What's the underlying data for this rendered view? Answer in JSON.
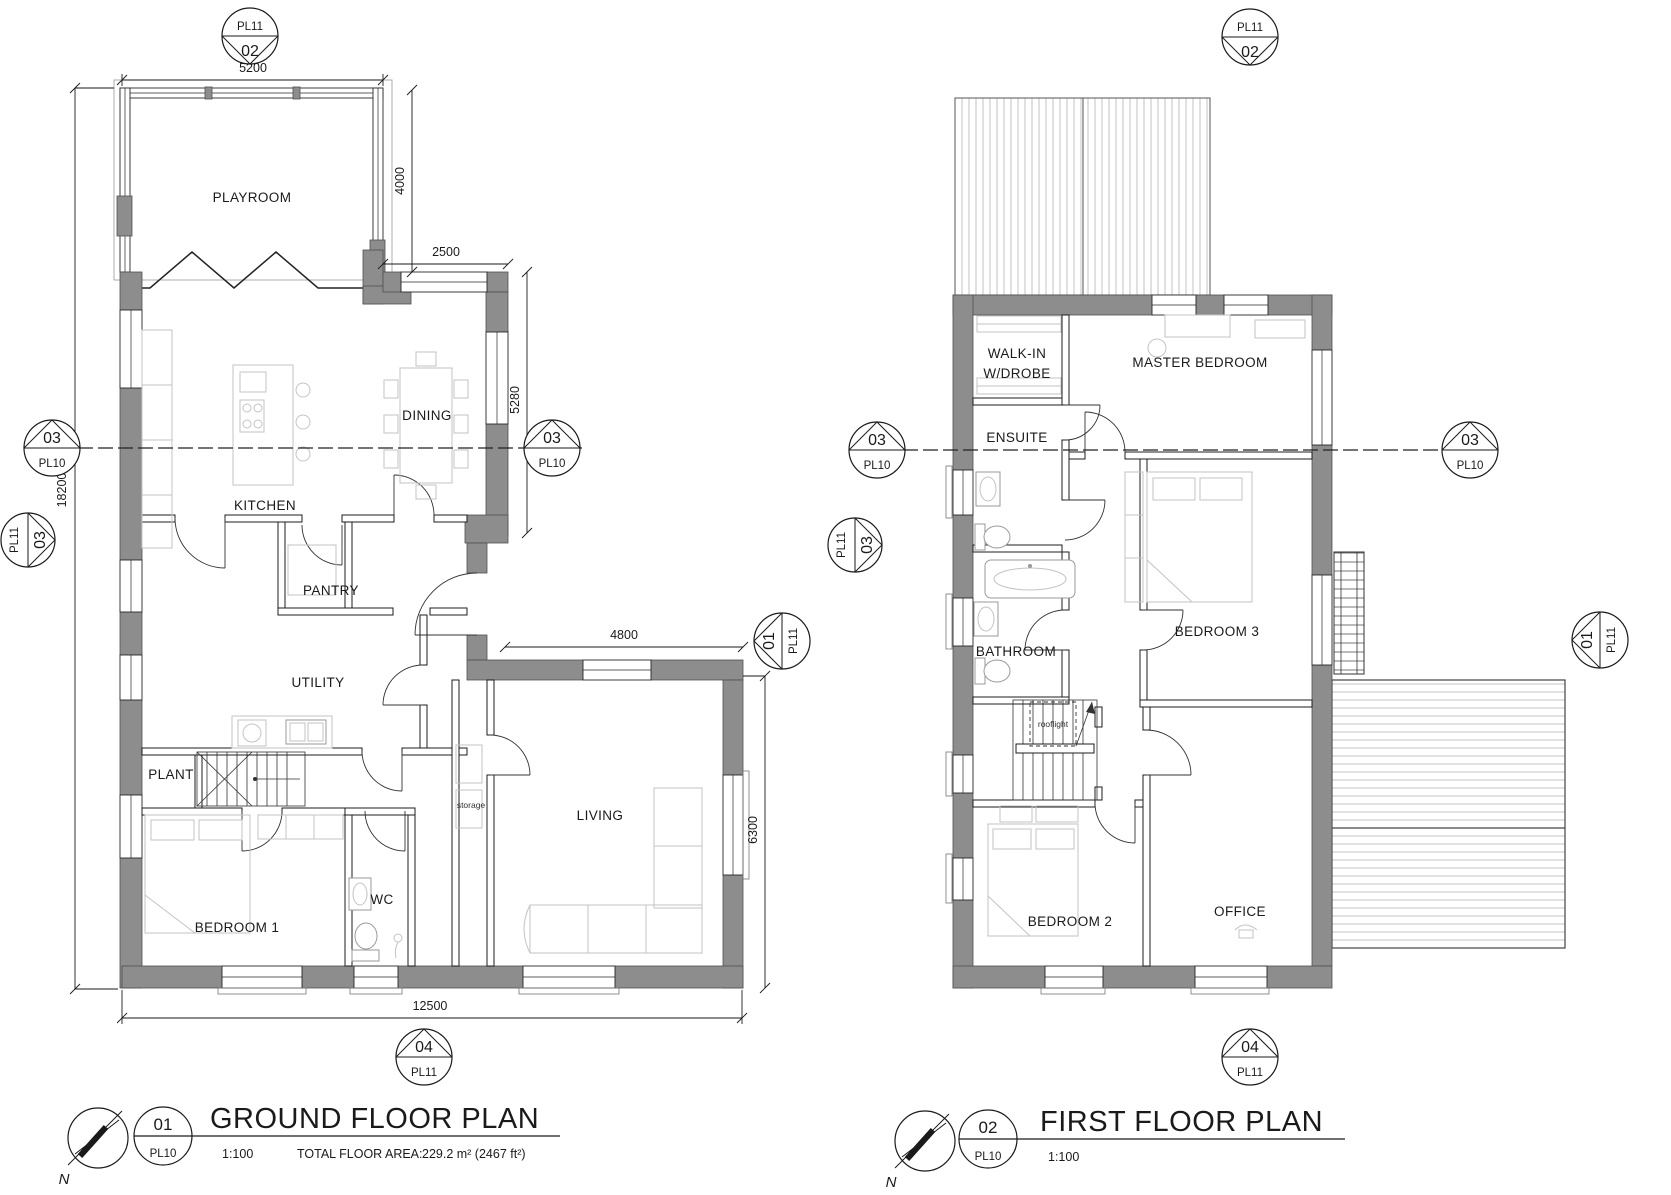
{
  "gf": {
    "title": {
      "number": "01",
      "sheet": "PL10",
      "name": "GROUND FLOOR PLAN",
      "scale": "1:100",
      "area_label": "TOTAL FLOOR AREA:",
      "area_value": "229.2 m² (2467 ft²)"
    },
    "north": "N",
    "rooms": {
      "playroom": "PLAYROOM",
      "dining": "DINING",
      "kitchen": "KITCHEN",
      "pantry": "PANTRY",
      "utility": "UTILITY",
      "plant": "PLANT",
      "bedroom1": "BEDROOM 1",
      "wc": "WC",
      "living": "LIVING",
      "storage": "storage"
    },
    "dims": {
      "top": "5200",
      "playroom_depth": "4000",
      "bay_width": "2500",
      "bay_depth": "5280",
      "overall_height": "18200",
      "living_width": "4800",
      "living_depth": "6300",
      "overall_width": "12500"
    },
    "markers": {
      "top": {
        "sheet": "PL11",
        "num": "02"
      },
      "section_left": {
        "num": "03",
        "sheet": "PL10"
      },
      "section_right": {
        "num": "03",
        "sheet": "PL10"
      },
      "side_left": {
        "sheet": "PL11",
        "num": "03"
      },
      "elev_right": {
        "num": "01",
        "sheet": "PL11"
      },
      "bottom": {
        "num": "04",
        "sheet": "PL11"
      }
    }
  },
  "ff": {
    "title": {
      "number": "02",
      "sheet": "PL10",
      "name": "FIRST FLOOR PLAN",
      "scale": "1:100"
    },
    "north": "N",
    "rooms": {
      "walkin_line1": "WALK-IN",
      "walkin_line2": "W/DROBE",
      "master": "MASTER BEDROOM",
      "ensuite": "ENSUITE",
      "bathroom": "BATHROOM",
      "bedroom3": "BEDROOM 3",
      "bedroom2": "BEDROOM 2",
      "office": "OFFICE",
      "rooflight": "rooflight"
    },
    "markers": {
      "top": {
        "sheet": "PL11",
        "num": "02"
      },
      "section_left": {
        "num": "03",
        "sheet": "PL10"
      },
      "section_right": {
        "num": "03",
        "sheet": "PL10"
      },
      "side_left": {
        "sheet": "PL11",
        "num": "03"
      },
      "elev_right": {
        "num": "01",
        "sheet": "PL11"
      },
      "bottom": {
        "num": "04",
        "sheet": "PL11"
      }
    }
  }
}
